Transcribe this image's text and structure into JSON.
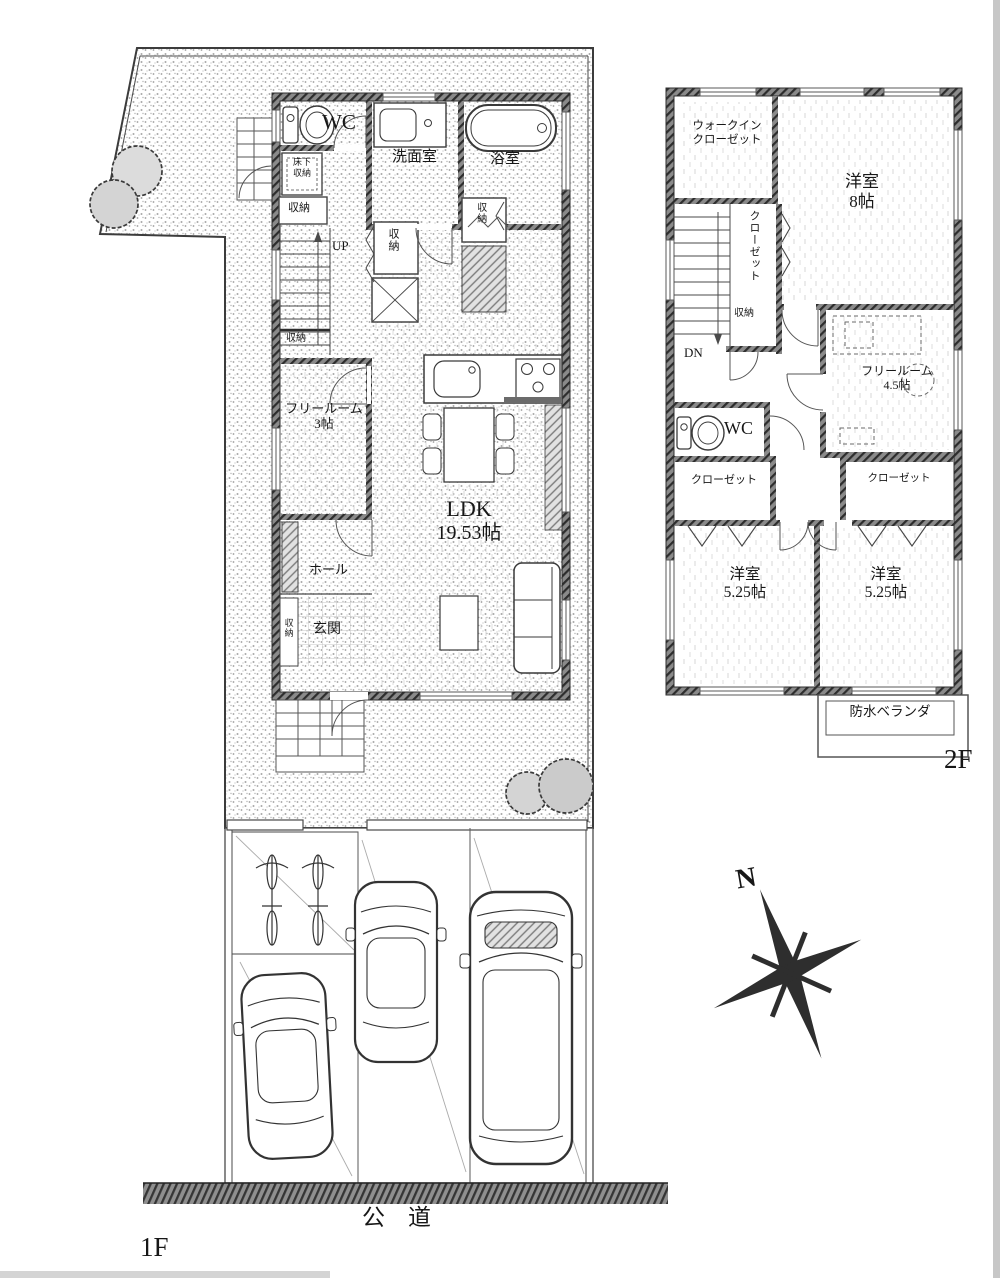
{
  "plan": {
    "floor1": {
      "label": "1F",
      "wc": "WC",
      "washroom": "洗面室",
      "bath": "浴室",
      "underfloor_l1": "床下",
      "underfloor_l2": "収納",
      "storage": "収納",
      "up": "UP",
      "free_l1": "フリールーム",
      "free_l2": "3帖",
      "ldk_l1": "LDK",
      "ldk_l2": "19.53帖",
      "hall": "ホール",
      "entrance": "玄関",
      "road": "公　道"
    },
    "floor2": {
      "label": "2F",
      "wic_l1": "ウォークイン",
      "wic_l2": "クローゼット",
      "closet": "クローゼット",
      "storage": "収納",
      "dn": "DN",
      "room8_l1": "洋室",
      "room8_l2": "8帖",
      "free_l1": "フリールーム",
      "free_l2": "4.5帖",
      "wc": "WC",
      "room525_l1": "洋室",
      "room525_l2": "5.25帖",
      "veranda": "防水ベランダ"
    },
    "compass_north": "N"
  }
}
